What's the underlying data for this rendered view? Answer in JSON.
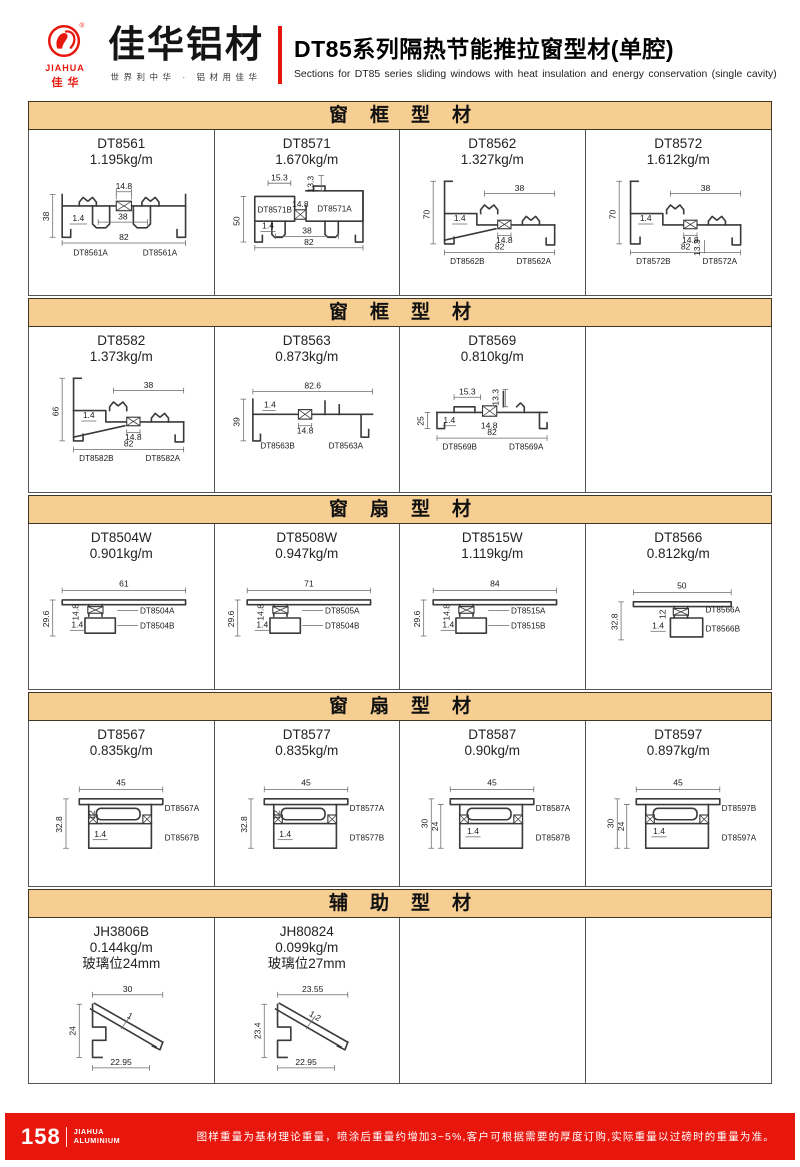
{
  "colors": {
    "accent_red": "#e8170e",
    "section_bg": "#f6ce92"
  },
  "header": {
    "logo_en": "JIAHUA",
    "logo_cn": "佳华",
    "brand_cn": "佳华铝材",
    "tagline": "世界利中华 · 铝材用佳华",
    "title_cn": "DT85系列隔热节能推拉窗型材(单腔)",
    "title_en": "Sections for DT85 series sliding windows with heat insulation and energy conservation (single cavity)"
  },
  "sections": [
    {
      "title": "窗框型材",
      "cells": [
        {
          "code": "DT8561",
          "weight": "1.195kg/m",
          "type": "frameSym",
          "dims": {
            "iso": "14.8",
            "left": "38",
            "t": "1.4",
            "mid": "38",
            "bottom": "82"
          },
          "parts": [
            "DT8561A",
            "DT8561A"
          ]
        },
        {
          "code": "DT8571",
          "weight": "1.670kg/m",
          "type": "frameBlocks",
          "dims": {
            "d1": "15.3",
            "d2": "13.3",
            "iso": "14.8",
            "left": "50",
            "t": "1.4",
            "mid": "38",
            "bottom": "82"
          },
          "parts": [
            "DT8571B",
            "DT8571A"
          ]
        },
        {
          "code": "DT8562",
          "weight": "1.327kg/m",
          "type": "frameStep",
          "dims": {
            "top": "38",
            "left": "70",
            "t": "1.4",
            "iso": "14.8",
            "bottom": "82"
          },
          "parts": [
            "DT8562B",
            "DT8562A"
          ]
        },
        {
          "code": "DT8572",
          "weight": "1.612kg/m",
          "type": "frameStep",
          "variant": "extra",
          "dims": {
            "top": "38",
            "left": "70",
            "t": "1.4",
            "iso": "14.8",
            "bottom": "82",
            "extra": "13.3"
          },
          "parts": [
            "DT8572B",
            "DT8572A"
          ]
        }
      ]
    },
    {
      "title": "窗框型材",
      "cells": [
        {
          "code": "DT8582",
          "weight": "1.373kg/m",
          "type": "frameStep",
          "dims": {
            "top": "38",
            "left": "66",
            "t": "1.4",
            "iso": "14.8",
            "bottom": "82"
          },
          "parts": [
            "DT8582B",
            "DT8582A"
          ]
        },
        {
          "code": "DT8563",
          "weight": "0.873kg/m",
          "type": "frameFlat",
          "variant": "8563",
          "dims": {
            "top": "82.6",
            "t": "1.4",
            "left": "39",
            "iso": "14.8"
          },
          "parts": [
            "DT8563B",
            "DT8563A"
          ]
        },
        {
          "code": "DT8569",
          "weight": "0.810kg/m",
          "type": "frameFlat",
          "variant": "8569",
          "dims": {
            "d1": "15.3",
            "d2": "13.3",
            "left": "25",
            "t": "1.4",
            "iso": "14.8",
            "bottom": "82"
          },
          "parts": [
            "DT8569B",
            "DT8569A"
          ]
        },
        null
      ]
    },
    {
      "title": "窗扇型材",
      "cells": [
        {
          "code": "DT8504W",
          "weight": "0.901kg/m",
          "type": "sashW",
          "dims": {
            "top": "61",
            "left": "29.6",
            "a": "14.8",
            "t": "1.4"
          },
          "parts": [
            "DT8504A",
            "DT8504B"
          ]
        },
        {
          "code": "DT8508W",
          "weight": "0.947kg/m",
          "type": "sashW",
          "dims": {
            "top": "71",
            "left": "29.6",
            "a": "14.8",
            "t": "1.4"
          },
          "parts": [
            "DT8505A",
            "DT8504B"
          ]
        },
        {
          "code": "DT8515W",
          "weight": "1.119kg/m",
          "type": "sashW",
          "dims": {
            "top": "84",
            "left": "29.6",
            "a": "14.8",
            "t": "1.4"
          },
          "parts": [
            "DT8515A",
            "DT8515B"
          ]
        },
        {
          "code": "DT8566",
          "weight": "0.812kg/m",
          "type": "sashNarrow",
          "dims": {
            "top": "50",
            "left": "32.8",
            "a": "12",
            "t": "1.4"
          },
          "parts": [
            "DT8566A",
            "DT8566B"
          ]
        }
      ]
    },
    {
      "title": "窗扇型材",
      "cells": [
        {
          "code": "DT8567",
          "weight": "0.835kg/m",
          "type": "boxSash",
          "dims": {
            "top": "45",
            "left": "32.8",
            "a": "12",
            "t": "1.4"
          },
          "parts": [
            "DT8567A",
            "DT8567B"
          ]
        },
        {
          "code": "DT8577",
          "weight": "0.835kg/m",
          "type": "boxSash",
          "dims": {
            "top": "45",
            "left": "32.8",
            "a": "12",
            "t": "1.4"
          },
          "parts": [
            "DT8577A",
            "DT8577B"
          ]
        },
        {
          "code": "DT8587",
          "weight": "0.90kg/m",
          "type": "boxSash",
          "variant": "deep",
          "dims": {
            "top": "45",
            "left": "30",
            "a": "24",
            "t": "1.4"
          },
          "parts": [
            "DT8587A",
            "DT8587B"
          ]
        },
        {
          "code": "DT8597",
          "weight": "0.897kg/m",
          "type": "boxSash",
          "variant": "deep",
          "dims": {
            "top": "45",
            "left": "30",
            "a": "24",
            "t": "1.4"
          },
          "parts": [
            "DT8597B",
            "DT8597A"
          ]
        }
      ]
    },
    {
      "title": "辅助型材",
      "cells": [
        {
          "code": "JH3806B",
          "weight": "0.144kg/m",
          "note": "玻璃位24mm",
          "type": "bead",
          "dims": {
            "top": "30",
            "left": "24",
            "t": "1",
            "bottom": "22.95"
          },
          "parts": []
        },
        {
          "code": "JH80824",
          "weight": "0.099kg/m",
          "note": "玻璃位27mm",
          "type": "bead",
          "dims": {
            "top": "23.55",
            "left": "23.4",
            "t": "1.2",
            "bottom": "22.95"
          },
          "parts": []
        },
        null,
        null
      ]
    }
  ],
  "footer": {
    "page_number": "158",
    "brand_line1": "JIAHUA",
    "brand_line2": "ALUMINIUM",
    "note": "图样重量为基材理论重量，喷涂后重量约增加3~5%,客户可根据需要的厚度订购,实际重量以过磅时的重量为准。"
  }
}
